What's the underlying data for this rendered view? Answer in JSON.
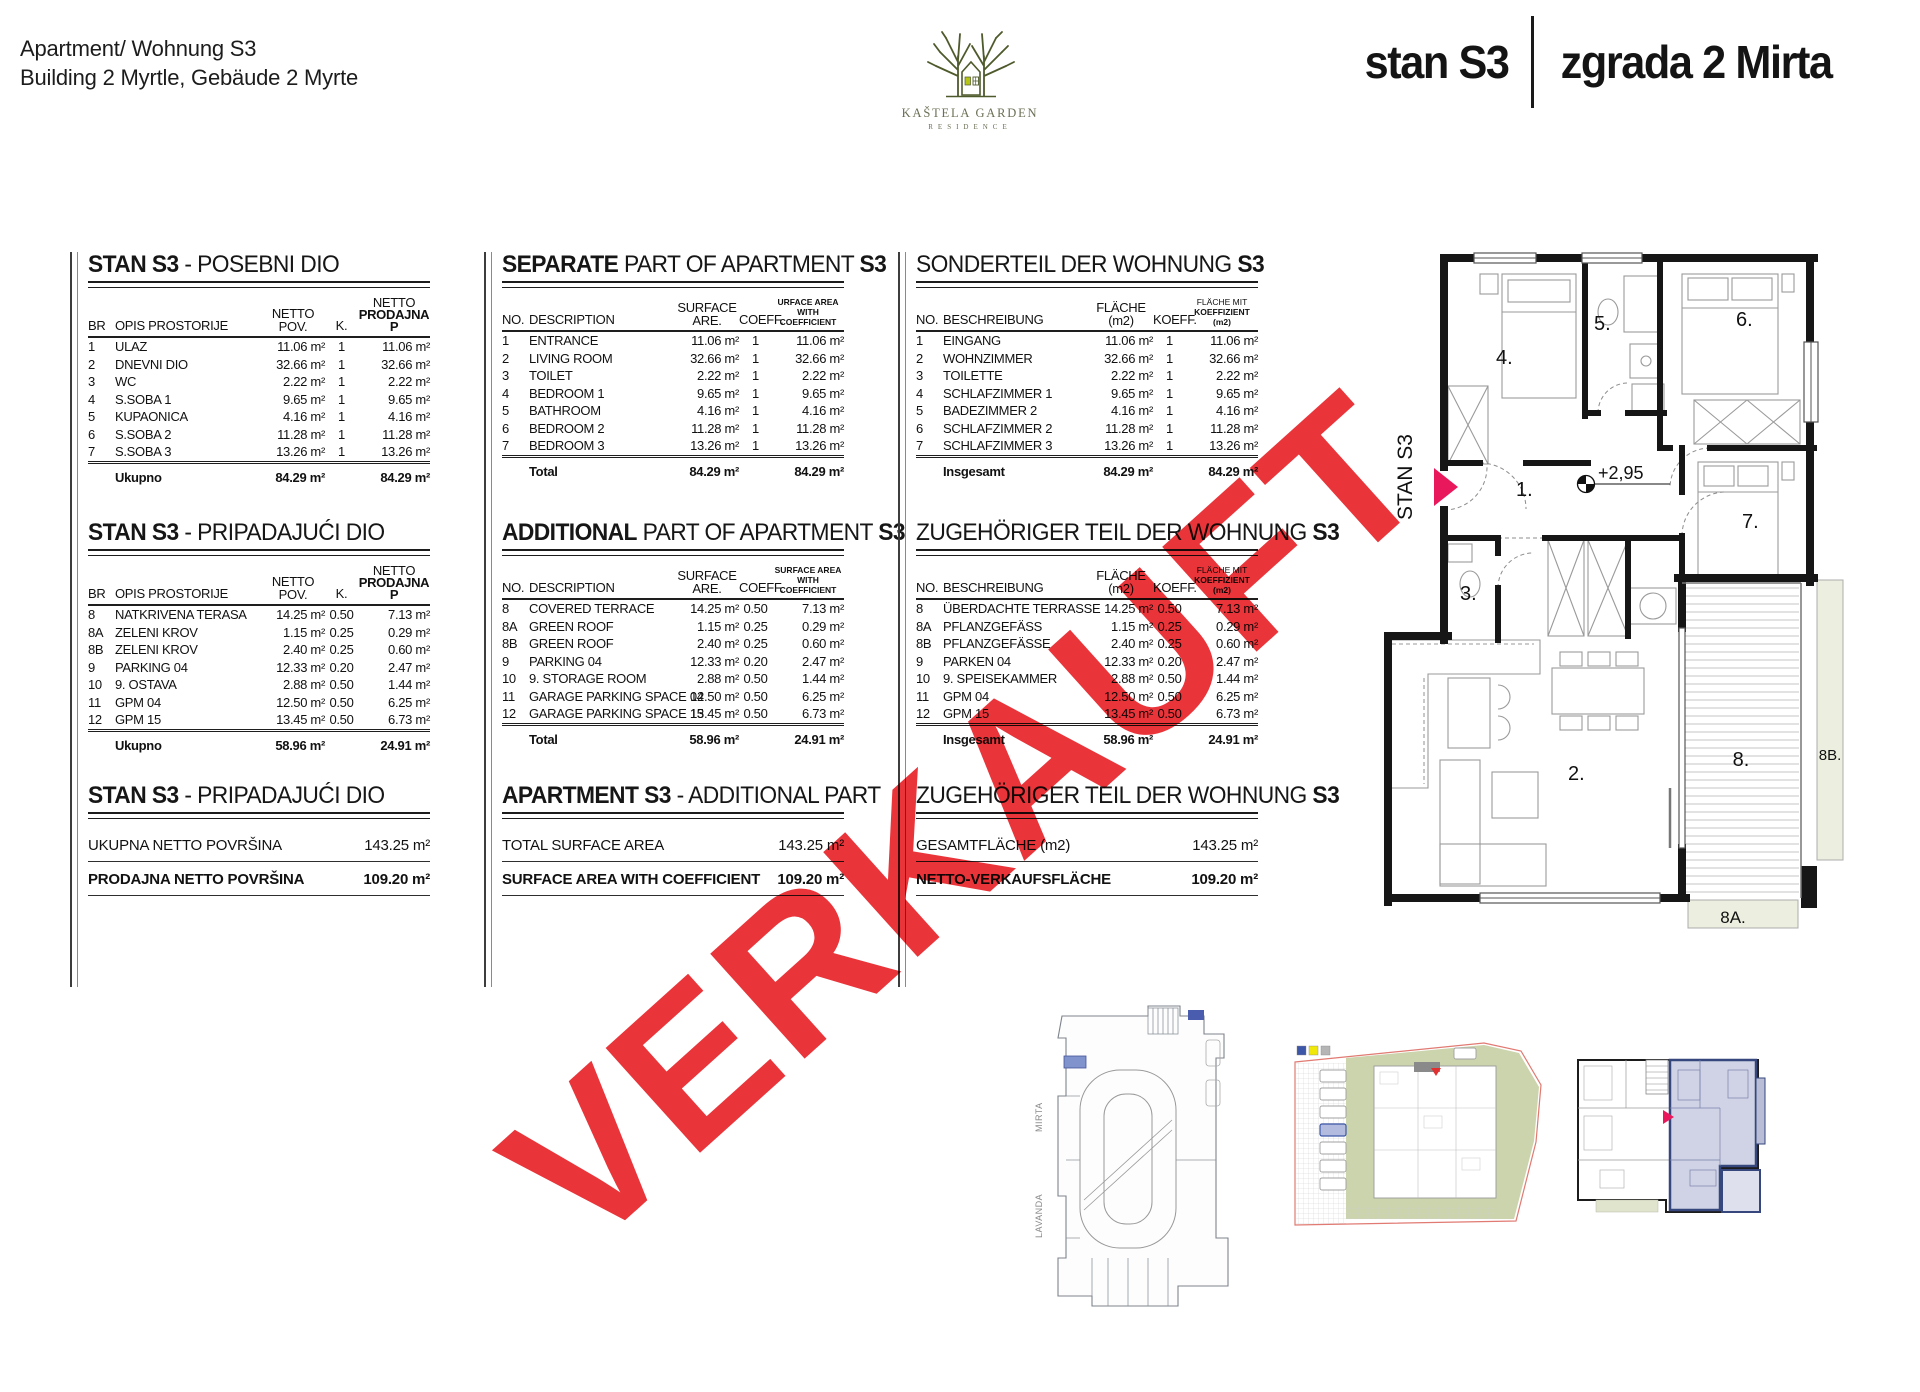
{
  "header": {
    "apartment_line": "Apartment/ Wohnung S3",
    "building_line": "Building 2 Myrtle, Gebäude 2 Myrte",
    "logo": {
      "name": "KAŠTELA GARDEN",
      "subtitle": "RESIDENCE"
    },
    "unit_title": "stan S3",
    "building_title": "zgrada 2 Mirta"
  },
  "watermark": {
    "text": "VERKAUFT",
    "color": "#e8292f"
  },
  "tables": {
    "separate": {
      "hr": {
        "title": {
          "b1": "STAN S3",
          "r": " - POSEBNI DIO",
          "b2": ""
        },
        "head": {
          "c1": "BR",
          "c2": "OPIS PROSTORIJE",
          "c3a": "NETTO",
          "c3b": "POV.",
          "c4": "K.",
          "c5a": "NETTO",
          "c5b": "PRODAJNA P"
        },
        "rows": [
          [
            "1",
            "ULAZ",
            "11.06 m²",
            "1",
            "11.06 m²"
          ],
          [
            "2",
            "DNEVNI DIO",
            "32.66 m²",
            "1",
            "32.66 m²"
          ],
          [
            "3",
            "WC",
            "2.22 m²",
            "1",
            "2.22 m²"
          ],
          [
            "4",
            "S.SOBA 1",
            "9.65 m²",
            "1",
            "9.65 m²"
          ],
          [
            "5",
            "KUPAONICA",
            "4.16 m²",
            "1",
            "4.16 m²"
          ],
          [
            "6",
            "S.SOBA 2",
            "11.28 m²",
            "1",
            "11.28 m²"
          ],
          [
            "7",
            "S.SOBA 3",
            "13.26 m²",
            "1",
            "13.26 m²"
          ]
        ],
        "total": {
          "label": "Ukupno",
          "area": "84.29 m²",
          "area2": "84.29 m²"
        }
      },
      "en": {
        "title": {
          "b1": "SEPARATE",
          "r": " PART OF APARTMENT ",
          "b2": "S3"
        },
        "head": {
          "c1": "NO.",
          "c2": "DESCRIPTION",
          "c3a": "SURFACE",
          "c3b": "ARE.",
          "c4": "COEFF.",
          "c5a": "URFACE AREA",
          "c5b": "WITH COEFFICIENT"
        },
        "rows": [
          [
            "1",
            "ENTRANCE",
            "11.06 m²",
            "1",
            "11.06 m²"
          ],
          [
            "2",
            "LIVING ROOM",
            "32.66 m²",
            "1",
            "32.66 m²"
          ],
          [
            "3",
            "TOILET",
            "2.22 m²",
            "1",
            "2.22 m²"
          ],
          [
            "4",
            "BEDROOM 1",
            "9.65 m²",
            "1",
            "9.65 m²"
          ],
          [
            "5",
            "BATHROOM",
            "4.16 m²",
            "1",
            "4.16 m²"
          ],
          [
            "6",
            "BEDROOM 2",
            "11.28 m²",
            "1",
            "11.28 m²"
          ],
          [
            "7",
            "BEDROOM 3",
            "13.26 m²",
            "1",
            "13.26 m²"
          ]
        ],
        "total": {
          "label": "Total",
          "area": "84.29 m²",
          "area2": "84.29 m²"
        }
      },
      "de": {
        "title": {
          "b1": "",
          "r": "SONDERTEIL DER WOHNUNG ",
          "b2": "S3"
        },
        "head": {
          "c1": "NO.",
          "c2": "BESCHREIBUNG",
          "c3a": "",
          "c3b": "FLÄCHE (m2)",
          "c4": "KOEFF.",
          "c5a": "FLÄCHE MIT",
          "c5b": "KOEFFIZIENT (m2)"
        },
        "rows": [
          [
            "1",
            "EINGANG",
            "11.06 m²",
            "1",
            "11.06 m²"
          ],
          [
            "2",
            "WOHNZIMMER",
            "32.66 m²",
            "1",
            "32.66 m²"
          ],
          [
            "3",
            "TOILETTE",
            "2.22 m²",
            "1",
            "2.22 m²"
          ],
          [
            "4",
            "SCHLAFZIMMER 1",
            "9.65 m²",
            "1",
            "9.65 m²"
          ],
          [
            "5",
            "BADEZIMMER 2",
            "4.16 m²",
            "1",
            "4.16 m²"
          ],
          [
            "6",
            "SCHLAFZIMMER 2",
            "11.28 m²",
            "1",
            "11.28 m²"
          ],
          [
            "7",
            "SCHLAFZIMMER 3",
            "13.26 m²",
            "1",
            "13.26 m²"
          ]
        ],
        "total": {
          "label": "Insgesamt",
          "area": "84.29 m²",
          "area2": "84.29 m²"
        }
      }
    },
    "additional": {
      "hr": {
        "title": {
          "b1": "STAN S3",
          "r": " - PRIPADAJUĆI DIO",
          "b2": ""
        },
        "head": {
          "c1": "BR",
          "c2": "OPIS PROSTORIJE",
          "c3a": "NETTO",
          "c3b": "POV.",
          "c4": "K.",
          "c5a": "NETTO",
          "c5b": "PRODAJNA P"
        },
        "rows": [
          [
            "8",
            "NATKRIVENA TERASA",
            "14.25 m²",
            "0.50",
            "7.13 m²"
          ],
          [
            "8A",
            "ZELENI KROV",
            "1.15 m²",
            "0.25",
            "0.29 m²"
          ],
          [
            "8B",
            "ZELENI KROV",
            "2.40 m²",
            "0.25",
            "0.60 m²"
          ],
          [
            "9",
            "PARKING 04",
            "12.33 m²",
            "0.20",
            "2.47 m²"
          ],
          [
            "10",
            "9. OSTAVA",
            "2.88 m²",
            "0.50",
            "1.44 m²"
          ],
          [
            "11",
            "GPM 04",
            "12.50 m²",
            "0.50",
            "6.25 m²"
          ],
          [
            "12",
            "GPM 15",
            "13.45 m²",
            "0.50",
            "6.73 m²"
          ]
        ],
        "total": {
          "label": "Ukupno",
          "area": "58.96 m²",
          "area2": "24.91 m²"
        }
      },
      "en": {
        "title": {
          "b1": "ADDITIONAL",
          "r": " PART OF APARTMENT ",
          "b2": "S3"
        },
        "head": {
          "c1": "NO.",
          "c2": "DESCRIPTION",
          "c3a": "SURFACE",
          "c3b": "ARE.",
          "c4": "COEFF.",
          "c5a": "SURFACE AREA",
          "c5b": "WITH COEFFICIENT"
        },
        "rows": [
          [
            "8",
            "COVERED TERRACE",
            "14.25 m²",
            "0.50",
            "7.13 m²"
          ],
          [
            "8A",
            "GREEN ROOF",
            "1.15 m²",
            "0.25",
            "0.29 m²"
          ],
          [
            "8B",
            "GREEN ROOF",
            "2.40 m²",
            "0.25",
            "0.60 m²"
          ],
          [
            "9",
            "PARKING 04",
            "12.33 m²",
            "0.20",
            "2.47 m²"
          ],
          [
            "10",
            "9. STORAGE ROOM",
            "2.88 m²",
            "0.50",
            "1.44 m²"
          ],
          [
            "11",
            "GARAGE PARKING SPACE 04",
            "12.50 m²",
            "0.50",
            "6.25 m²"
          ],
          [
            "12",
            "GARAGE PARKING SPACE 15",
            "13.45 m²",
            "0.50",
            "6.73 m²"
          ]
        ],
        "total": {
          "label": "Total",
          "area": "58.96 m²",
          "area2": "24.91 m²"
        }
      },
      "de": {
        "title": {
          "b1": "",
          "r": "ZUGEHÖRIGER TEIL DER WOHNUNG ",
          "b2": "S3"
        },
        "head": {
          "c1": "NO.",
          "c2": "BESCHREIBUNG",
          "c3a": "",
          "c3b": "FLÄCHE (m2)",
          "c4": "KOEFF.",
          "c5a": "FLÄCHE MIT",
          "c5b": "KOEFFIZIENT (m2)"
        },
        "rows": [
          [
            "8",
            "ÜBERDACHTE TERRASSE",
            "14.25 m²",
            "0.50",
            "7.13 m²"
          ],
          [
            "8A",
            "PFLANZGEFÄSS",
            "1.15 m²",
            "0.25",
            "0.29 m²"
          ],
          [
            "8B",
            "PFLANZGEFÄSSE",
            "2.40 m²",
            "0.25",
            "0.60 m²"
          ],
          [
            "9",
            "PARKEN 04",
            "12.33 m²",
            "0.20",
            "2.47 m²"
          ],
          [
            "10",
            "9. SPEISEKAMMER",
            "2.88 m²",
            "0.50",
            "1.44 m²"
          ],
          [
            "11",
            "GPM 04",
            "12.50 m²",
            "0.50",
            "6.25 m²"
          ],
          [
            "12",
            "GPM 15",
            "13.45 m²",
            "0.50",
            "6.73 m²"
          ]
        ],
        "total": {
          "label": "Insgesamt",
          "area": "58.96 m²",
          "area2": "24.91 m²"
        }
      }
    },
    "summary": {
      "hr": {
        "title": {
          "b1": "STAN S3",
          "r": " - PRIPADAJUĆI DIO",
          "b2": ""
        },
        "r1l": "UKUPNA NETTO POVRŠINA",
        "r1v": "143.25 m²",
        "r2l": "PRODAJNA NETTO POVRŠINA",
        "r2v": "109.20 m²"
      },
      "en": {
        "title": {
          "b1": "APARTMENT S3",
          "r": " - ADDITIONAL PART",
          "b2": ""
        },
        "r1l": "TOTAL SURFACE AREA",
        "r1v": "143.25 m²",
        "r2l": "SURFACE AREA WITH COEFFICIENT",
        "r2v": "109.20 m²"
      },
      "de": {
        "title": {
          "b1": "",
          "r": "ZUGEHÖRIGER TEIL DER WOHNUNG ",
          "b2": "S3"
        },
        "r1l": "GESAMTFLÄCHE (m2)",
        "r1v": "143.25 m²",
        "r2l": "NETTO-VERKAUFSFLÄCHE",
        "r2v": "109.20 m²"
      }
    }
  },
  "floorplan": {
    "unit_label": "STAN S3",
    "elevation": "+2,95",
    "rooms": {
      "r1": "1.",
      "r2": "2.",
      "r3": "3.",
      "r4": "4.",
      "r5": "5.",
      "r6": "6.",
      "r7": "7.",
      "r8": "8.",
      "r8a": "8A.",
      "r8b": "8B."
    }
  },
  "site_plans": {
    "street1": "LAVANDA",
    "street2": "MIRTA"
  },
  "colors": {
    "watermark_red": "#e8292f",
    "entrance_pink": "#e9185c",
    "site_green": "#cbd4ac",
    "unit_blue_fill": "#c8cbe1",
    "unit_blue_border": "#35477d",
    "roof_green": "#ecefe0",
    "logo_olive": "#4e5a2b"
  }
}
